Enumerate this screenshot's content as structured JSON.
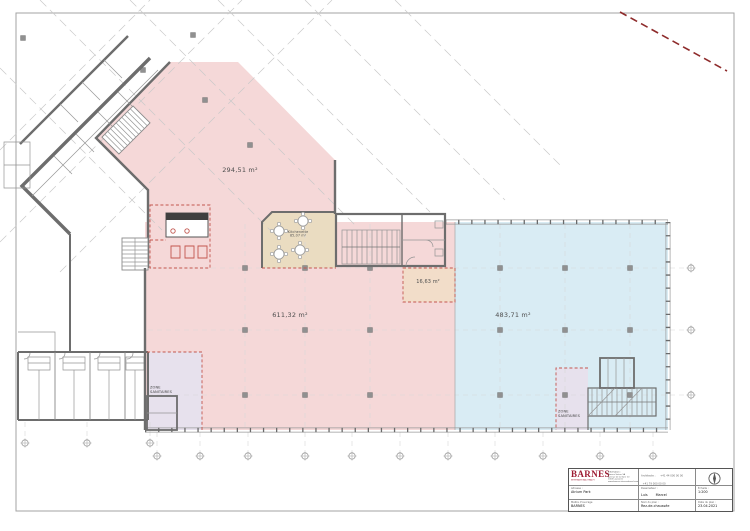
{
  "colors": {
    "zone_pink": "#f5d8d8",
    "zone_blue": "#d9ecf4",
    "zone_tan": "#eadcc1",
    "zone_peach": "#f2ddc9",
    "zone_lavender": "#e7e1ed",
    "wall_gray": "#6d6d6d",
    "red_detail": "#c2564e",
    "red_dash": "#8e2b2b",
    "logo_red": "#9d1b32"
  },
  "areas": {
    "upper_zone": "294,51 m²",
    "main_zone": "611,32 m²",
    "blue_zone": "483,71 m²",
    "small_room": "16,63 m²",
    "kitchenette_name": "Kitchenette",
    "kitchenette_area": "85,07 m²",
    "sanitaires_line1": "ZONE",
    "sanitaires_line2": "SANITAIRES"
  },
  "title_block": {
    "logo_text": "BARNES",
    "logo_tagline": "INTERNATIONAL REALTY",
    "info_label": "Information :",
    "info_lines": [
      "Barnes Suisse SA",
      "Avenue de la Gare 10",
      "1003 Lausanne",
      "www.barnes-international.com"
    ],
    "architect_label": "Architecte :",
    "architect_phone1": "+41 44 000 00 00",
    "architect_phone2": "+41 79 000 00 00",
    "architect_name1": "Moritz",
    "architect_name2": "Dominik",
    "architect_email_label": "Email :",
    "architect_email": "info@barnes-suisse.com",
    "address_label": "Adresse :",
    "address_value": "Atrium Park",
    "draftsman_label": "Dessinateur :",
    "draftsman_name1": "Luis",
    "draftsman_name2": "Marcel",
    "scale_label": "Échelle :",
    "scale_value": "1:200",
    "owner_label": "Maître d'ouvrage",
    "owner_value": "BARNES",
    "plan_label": "Nom du plan :",
    "plan_value": "Rez-de-chaussée",
    "date_label": "Date du plan :",
    "date_value": "23.04.2021"
  }
}
